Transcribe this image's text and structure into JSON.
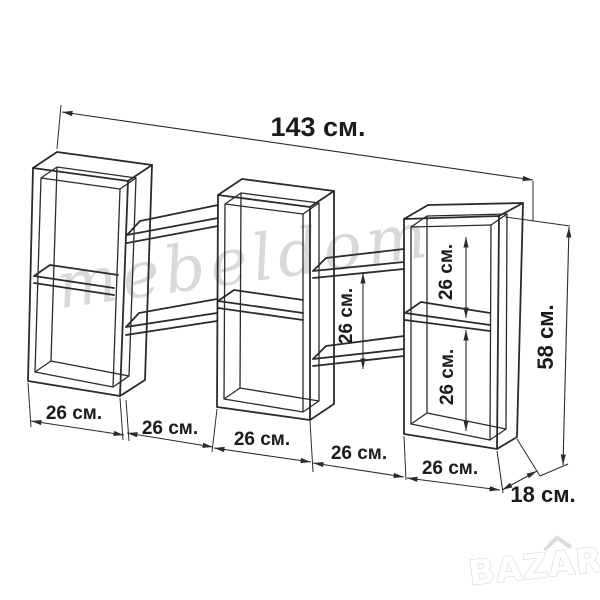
{
  "diagram": {
    "type": "furniture-dimension-drawing",
    "subject": "wall shelf unit, three double-compartment boxes connected by staggered shelves",
    "dimensions": {
      "total_width": "143 см.",
      "total_height": "58 см.",
      "depth": "18 см.",
      "bottom_segments": [
        "26 см.",
        "26 см.",
        "26 см.",
        "26 см.",
        "26 см."
      ],
      "right_box_upper_compartment": "26 см.",
      "right_box_lower_compartment": "26 см.",
      "middle_right_shelf_gap": "26 см."
    },
    "watermark": {
      "text": "mebeldom"
    },
    "logo": {
      "text": "BAZAR"
    },
    "colors": {
      "background": "#ffffff",
      "line": "#2b2b2b",
      "label": "#1b1b1b",
      "watermark": "#d9d9d9",
      "logo_fill": "#ffffff",
      "logo_outline": "#dcdcdc"
    }
  }
}
